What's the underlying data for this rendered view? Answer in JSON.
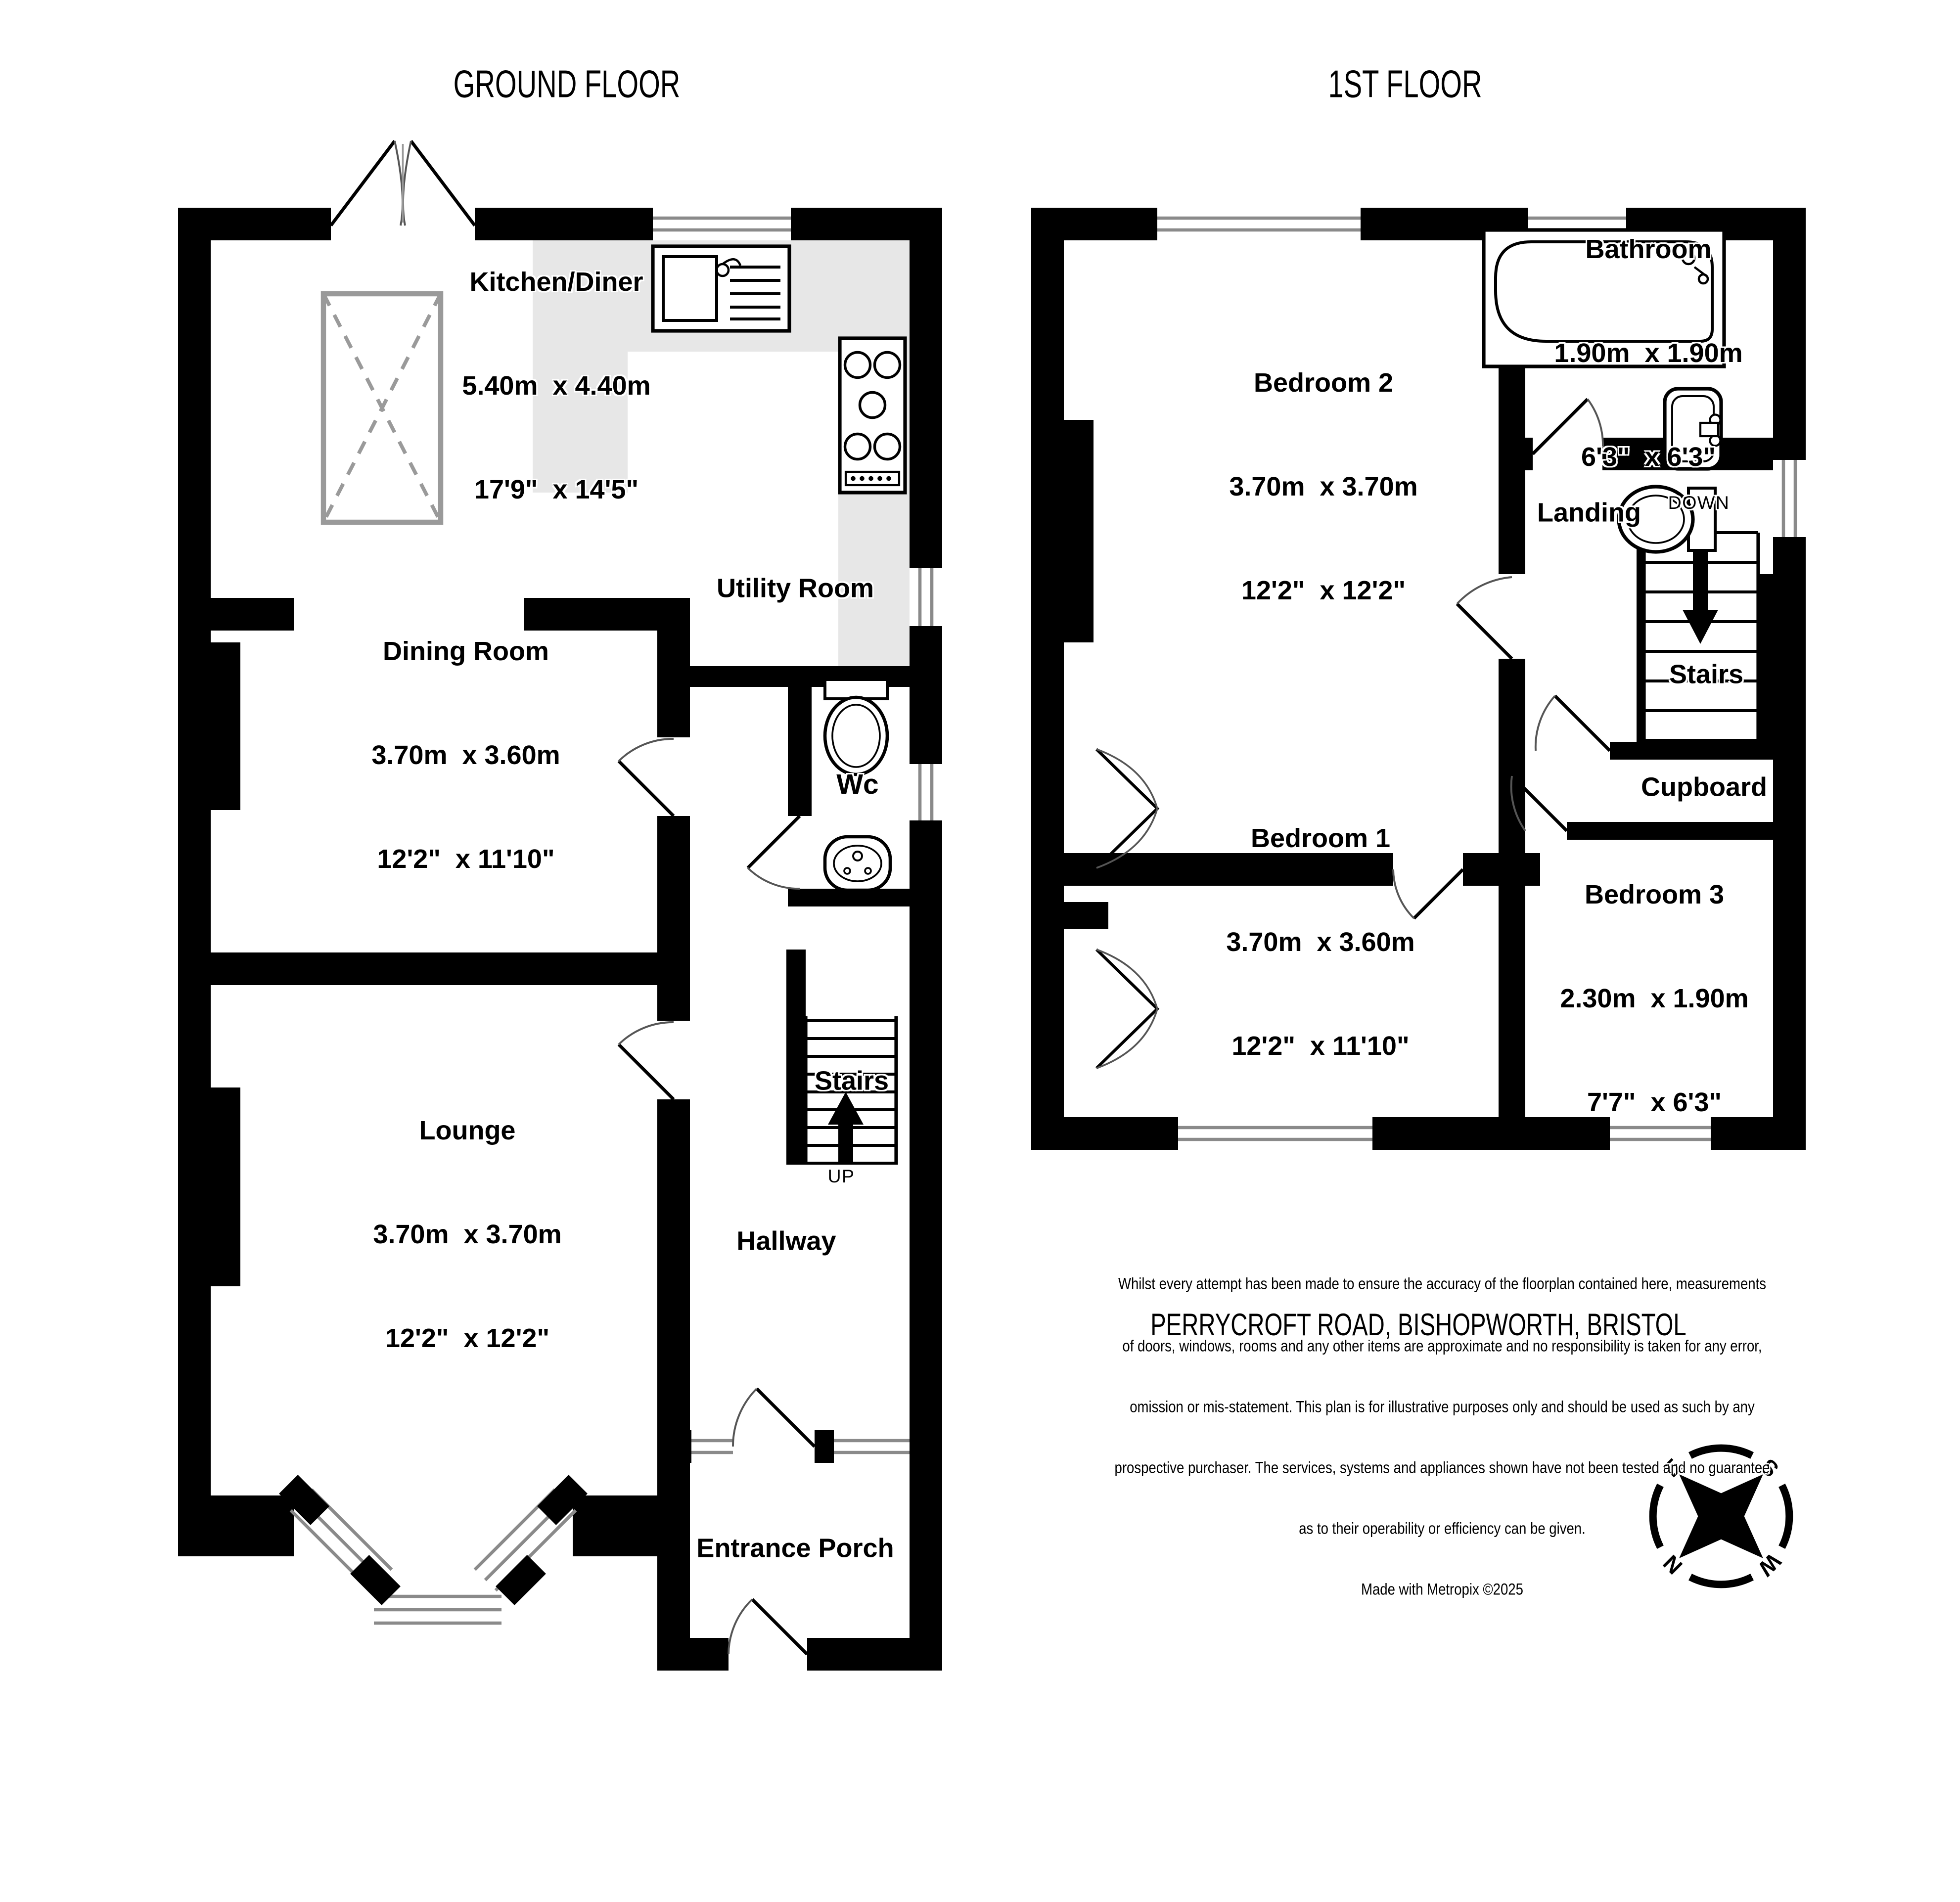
{
  "titles": {
    "ground": "GROUND FLOOR",
    "first": "1ST FLOOR"
  },
  "ground_floor": {
    "kitchen": {
      "name": "Kitchen/Diner",
      "metric": "5.40m  x 4.40m",
      "imperial": "17'9\"  x 14'5\""
    },
    "dining": {
      "name": "Dining Room",
      "metric": "3.70m  x 3.60m",
      "imperial": "12'2\"  x 11'10\""
    },
    "lounge": {
      "name": "Lounge",
      "metric": "3.70m  x 3.70m",
      "imperial": "12'2\"  x 12'2\""
    },
    "utility": {
      "name": "Utility Room"
    },
    "wc": {
      "name": "Wc"
    },
    "stairs": {
      "name": "Stairs",
      "direction": "UP"
    },
    "hallway": {
      "name": "Hallway"
    },
    "entrance_porch": {
      "name": "Entrance Porch"
    }
  },
  "first_floor": {
    "bedroom2": {
      "name": "Bedroom 2",
      "metric": "3.70m  x 3.70m",
      "imperial": "12'2\"  x 12'2\""
    },
    "bathroom": {
      "name": "Bathroom",
      "metric": "1.90m  x 1.90m",
      "imperial": "6'3\"  x 6'3\""
    },
    "landing": {
      "name": "Landing"
    },
    "stairs": {
      "name": "Stairs",
      "direction": "DOWN"
    },
    "cupboard": {
      "name": "Cupboard"
    },
    "bedroom1": {
      "name": "Bedroom 1",
      "metric": "3.70m  x 3.60m",
      "imperial": "12'2\"  x 11'10\""
    },
    "bedroom3": {
      "name": "Bedroom 3",
      "metric": "2.30m  x 1.90m",
      "imperial": "7'7\"  x 6'3\""
    }
  },
  "footer": {
    "address": "PERRYCROFT ROAD, BISHOPWORTH, BRISTOL",
    "disclaimer_line1": "Whilst every attempt has been made to ensure the accuracy of the floorplan contained here, measurements",
    "disclaimer_line2": "of doors, windows, rooms and any other items are approximate and no responsibility is taken for any error,",
    "disclaimer_line3": "omission or mis-statement. This plan is for illustrative purposes only and should be used as such by any",
    "disclaimer_line4": "prospective purchaser. The services, systems and appliances shown have not been tested and no guarantee",
    "disclaimer_line5": "as to their operability or efficiency can be given.",
    "credit": "Made with Metropix ©2025"
  },
  "compass": {
    "north": "N",
    "south": "S",
    "east": "E",
    "west": "W"
  }
}
